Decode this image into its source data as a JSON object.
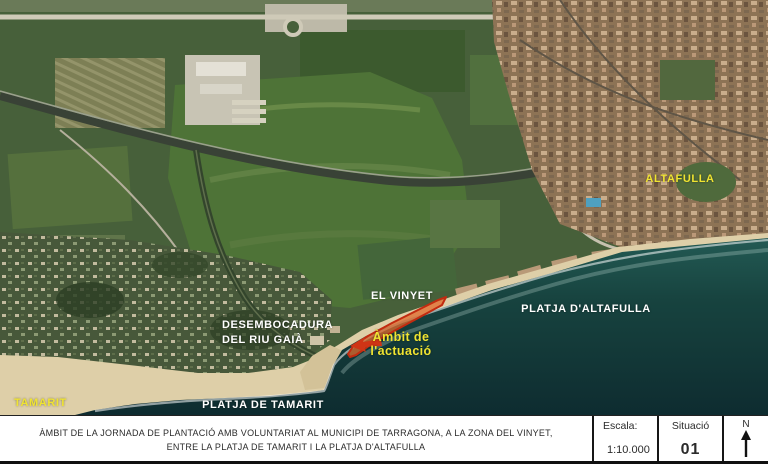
{
  "map_labels": {
    "altafulla": "ALTAFULLA",
    "el_vinyet": "EL VINYET",
    "platja_altafulla": "PLATJA D'ALTAFULLA",
    "desembocadura_line1": "DESEMBOCADURA",
    "desembocadura_line2": "DEL RIU GAIÀ",
    "ambit_line1": "Àmbit de",
    "ambit_line2": "l'actuació",
    "tamarit": "TAMARIT",
    "platja_tamarit": "PLATJA DE TAMARIT"
  },
  "title_block": {
    "caption_line1": "ÀMBIT DE LA JORNADA DE PLANTACIÓ AMB VOLUNTARIAT AL MUNICIPI DE TARRAGONA, A LA ZONA DEL VINYET,",
    "caption_line2": "ENTRE LA PLATJA DE TAMARIT I LA PLATJA D'ALTAFULLA",
    "scale_label": "Escala:",
    "scale_value": "1:10.000",
    "situation_label": "Situació",
    "situation_value": "01",
    "north_label": "N"
  },
  "colors": {
    "label_yellow": "#f0e431",
    "label_white": "#ffffff",
    "ambit_outline_red": "#c22b10",
    "ambit_fill_orange": "#e06a2c",
    "sea_dark": "#16393c",
    "sand": "#decfa8",
    "field_green": "#47603a"
  }
}
